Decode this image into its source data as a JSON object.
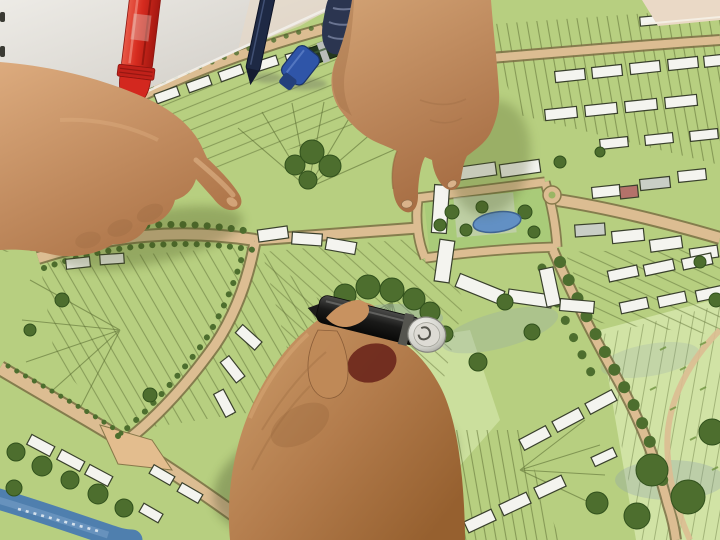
{
  "scene": {
    "setting": "Photograph: two hands point at a hand-drawn urban master-plan map on a white table while a third foreground hand holds a capped pen over the drawing; marker pens lie at the top edge of the map",
    "surface_label": "white table surface",
    "map_label": "housing development master plan drawing",
    "objects": {
      "map": "site master plan: yellow-green fields subdivided into plots, tan roads, white building blocks, dark green trees, village centre with pond, blue stream at lower left",
      "left_hand": "hand entering from the left, index finger pointing at radiating housing plots",
      "top_hand": "hand entering from the top, index finger pointing near the village centre",
      "writing_hand": "large foreground hand holding a dark pen with a silver cap end",
      "pen_in_hand": "dark pen with silver cap end held over the map",
      "red_marker": "red marker standing cap-down on the map edge",
      "navy_pen": "dark navy pen lying on the table",
      "green_marker": "dark green marker with a blue chisel cap",
      "second_dark_pen": "second dark marker behind the sleeve",
      "sleeve": "dark striped sleeve cuff at the top edge",
      "pond": "small blue pond in the village green",
      "stream": "blue stream band with white lettering at lower left",
      "roundabout": "small road circle at the village main street",
      "junction": "tan road junction at lower left"
    },
    "map_features": {
      "roads": "tan/salmon streets with dark casings",
      "buildings": "small white rectangles outlined in dark ink, some grey",
      "trees": "dark green circular canopies with blue-grey shadows",
      "plots": "thin olive subdivision lines radiating in fans",
      "open_space": "light green parkland at bottom right"
    },
    "palette": {
      "map_base": "#b7cf80",
      "map_light": "#d2e4a6",
      "road": "#dcbd92",
      "building": "#f4f4ef",
      "tree": "#4d6e2e",
      "pond": "#6290c4",
      "stream": "#4f7fae",
      "table": "#e2dfd9",
      "skin": "#c89468",
      "red_marker": "#d62b1f",
      "blue_cap": "#2f55a8",
      "sleeve": "#2b3550"
    }
  }
}
